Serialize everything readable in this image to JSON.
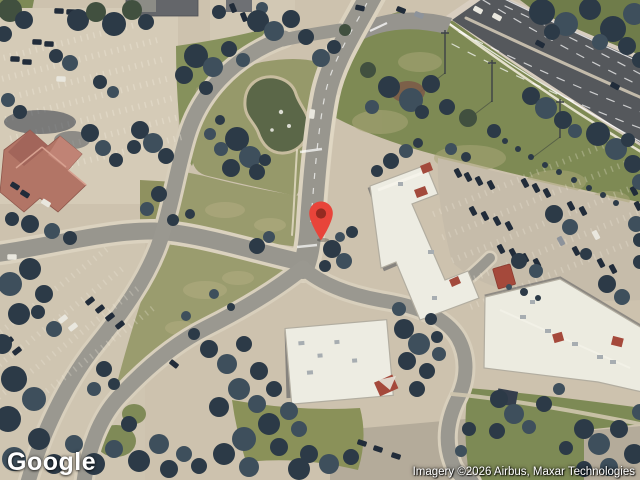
{
  "branding": {
    "logo_text": "Google"
  },
  "attribution": {
    "text": "Imagery ©2026 Airbus, Maxar Technologies"
  },
  "marker": {
    "color": "#E8443A",
    "dot_color": "#942A21"
  }
}
